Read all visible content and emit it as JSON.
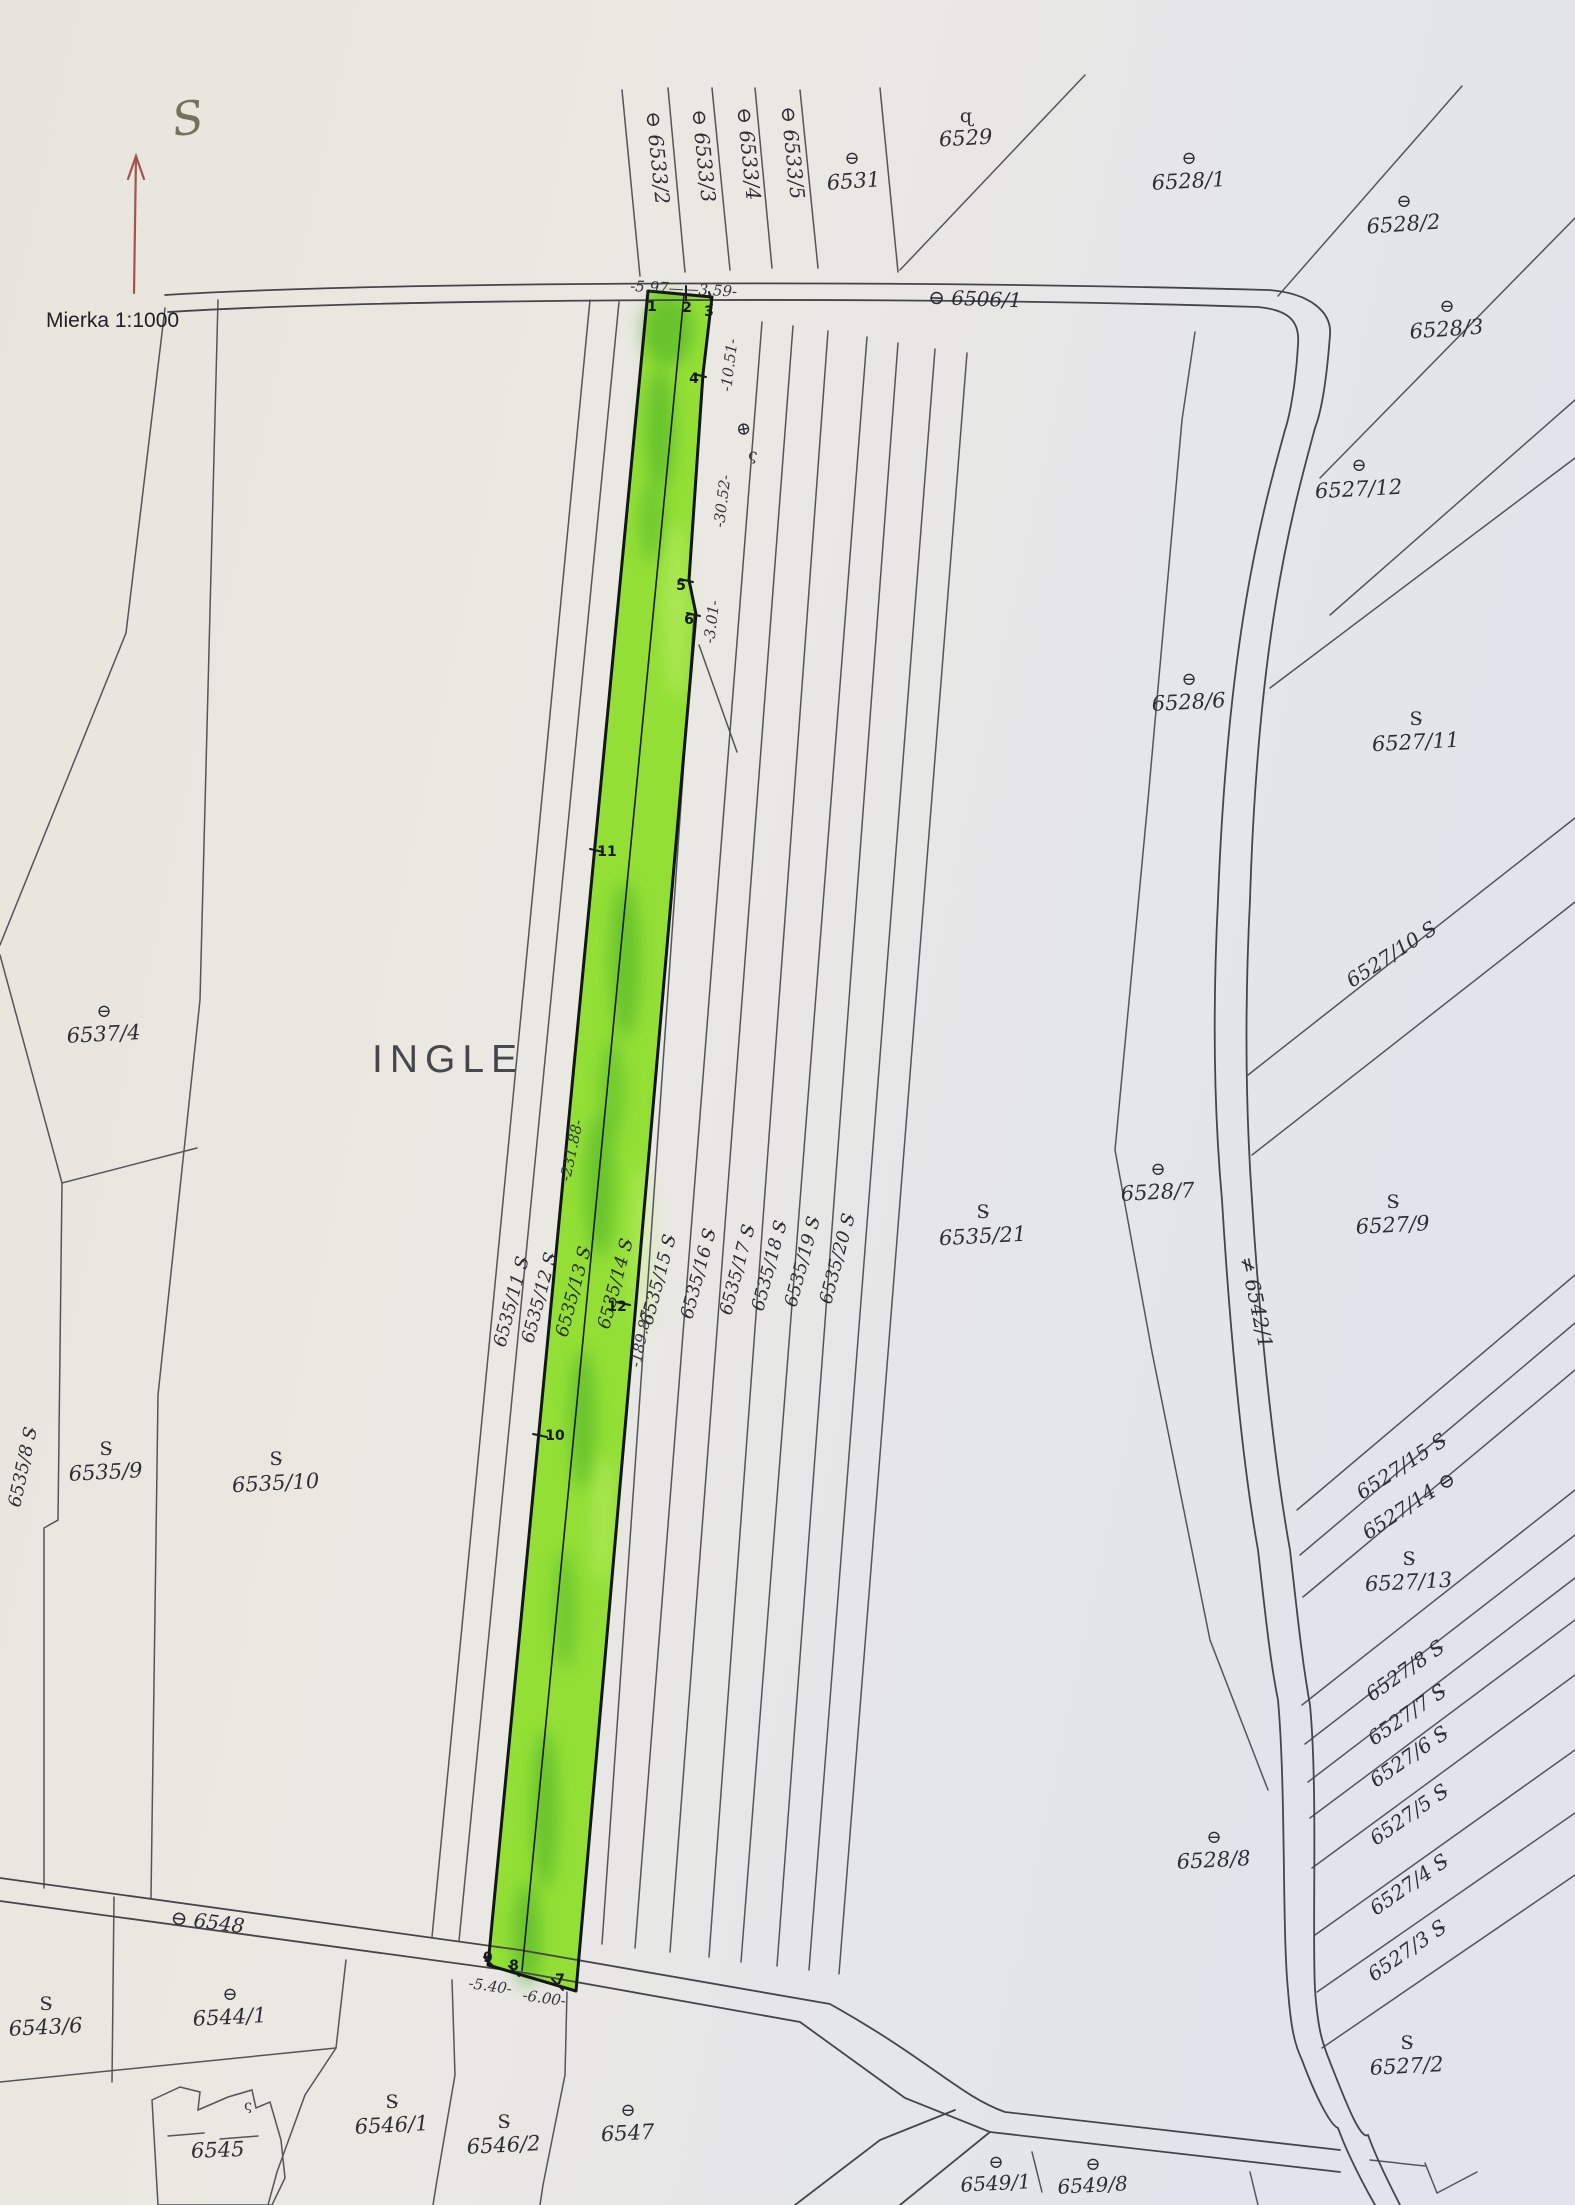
{
  "document": {
    "type": "cadastral-map-scan",
    "scale_label": "Mierka 1:1000",
    "north_label": "S",
    "area_name": "INGLE",
    "highlighted_parcels": [
      "6535/13",
      "6535/14"
    ]
  },
  "map": {
    "paper_color": "#e8e6e1",
    "line_color": "#53555a",
    "highlight_color": "#93df36",
    "north_arrow_color": "#a3544b",
    "labels": [
      {
        "n": "north-label",
        "t": "S",
        "x": 190,
        "y": 134,
        "r": -8,
        "s": 46,
        "a": "m",
        "c": "north"
      },
      {
        "n": "scale-label",
        "t": "Mierka 1:1000",
        "x": 46,
        "y": 327,
        "r": 0,
        "s": 21,
        "a": "s",
        "c": "scale"
      },
      {
        "n": "area-name",
        "t": "INGLE",
        "x": 372,
        "y": 1072,
        "r": 0,
        "s": 39,
        "a": "s",
        "c": "area"
      },
      {
        "n": "parcel-label-6533-2",
        "t": "⊖ 6533/2",
        "x": 646,
        "y": 112,
        "r": 84,
        "s": 20,
        "a": "s",
        "c": "num"
      },
      {
        "n": "parcel-label-6533-3",
        "t": "⊖ 6533/3",
        "x": 692,
        "y": 110,
        "r": 84,
        "s": 20,
        "a": "s",
        "c": "num"
      },
      {
        "n": "parcel-label-6533-4",
        "t": "⊖ 6533/4",
        "x": 737,
        "y": 108,
        "r": 84,
        "s": 20,
        "a": "s",
        "c": "num"
      },
      {
        "n": "parcel-label-6533-5",
        "t": "⊖ 6533/5",
        "x": 781,
        "y": 107,
        "r": 84,
        "s": 20,
        "a": "s",
        "c": "num"
      },
      {
        "n": "symbol-6531",
        "t": "⊖",
        "x": 852,
        "y": 164,
        "r": 0,
        "s": 18,
        "a": "m",
        "c": "sym"
      },
      {
        "n": "parcel-label-6531",
        "t": "6531",
        "x": 854,
        "y": 188,
        "r": -4,
        "s": 21,
        "a": "m",
        "c": "num"
      },
      {
        "n": "symbol-6529",
        "t": "ɋ",
        "x": 966,
        "y": 122,
        "r": 0,
        "s": 19,
        "a": "m",
        "c": "sym"
      },
      {
        "n": "parcel-label-6529",
        "t": "6529",
        "x": 966,
        "y": 145,
        "r": -3,
        "s": 21,
        "a": "m",
        "c": "num"
      },
      {
        "n": "parcel-label-6506-1",
        "t": "⊖ 6506/1",
        "x": 928,
        "y": 304,
        "r": 2,
        "s": 20,
        "a": "s",
        "c": "num"
      },
      {
        "n": "symbol-6528-1",
        "t": "⊖",
        "x": 1189,
        "y": 164,
        "r": 0,
        "s": 18,
        "a": "m",
        "c": "sym"
      },
      {
        "n": "parcel-label-6528-1",
        "t": "6528/1",
        "x": 1189,
        "y": 188,
        "r": -3,
        "s": 21,
        "a": "m",
        "c": "num"
      },
      {
        "n": "symbol-6528-2",
        "t": "⊖",
        "x": 1404,
        "y": 207,
        "r": 0,
        "s": 18,
        "a": "m",
        "c": "sym"
      },
      {
        "n": "parcel-label-6528-2",
        "t": "6528/2",
        "x": 1404,
        "y": 231,
        "r": -4,
        "s": 21,
        "a": "m",
        "c": "num"
      },
      {
        "n": "symbol-6528-3",
        "t": "⊖",
        "x": 1447,
        "y": 312,
        "r": 0,
        "s": 18,
        "a": "m",
        "c": "sym"
      },
      {
        "n": "parcel-label-6528-3",
        "t": "6528/3",
        "x": 1447,
        "y": 336,
        "r": -4,
        "s": 21,
        "a": "m",
        "c": "num"
      },
      {
        "n": "symbol-6527-12",
        "t": "⊖",
        "x": 1359,
        "y": 471,
        "r": 0,
        "s": 18,
        "a": "m",
        "c": "sym"
      },
      {
        "n": "parcel-label-6527-12",
        "t": "6527/12",
        "x": 1359,
        "y": 496,
        "r": -3,
        "s": 21,
        "a": "m",
        "c": "num"
      },
      {
        "n": "symbol-6528-6",
        "t": "⊖",
        "x": 1189,
        "y": 685,
        "r": 0,
        "s": 18,
        "a": "m",
        "c": "sym"
      },
      {
        "n": "parcel-label-6528-6",
        "t": "6528/6",
        "x": 1189,
        "y": 709,
        "r": -3,
        "s": 21,
        "a": "m",
        "c": "num"
      },
      {
        "n": "symbol-6527-11",
        "t": "S̵",
        "x": 1416,
        "y": 725,
        "r": 0,
        "s": 19,
        "a": "m",
        "c": "sym"
      },
      {
        "n": "parcel-label-6527-11",
        "t": "6527/11",
        "x": 1416,
        "y": 749,
        "r": -3,
        "s": 21,
        "a": "m",
        "c": "num"
      },
      {
        "n": "parcel-label-6527-10",
        "t": "6527/10 S̵",
        "x": 1352,
        "y": 988,
        "r": -33,
        "s": 20,
        "a": "s",
        "c": "num"
      },
      {
        "n": "symbol-6527-9",
        "t": "S̵",
        "x": 1393,
        "y": 1208,
        "r": 0,
        "s": 19,
        "a": "m",
        "c": "sym"
      },
      {
        "n": "parcel-label-6527-9",
        "t": "6527/9",
        "x": 1393,
        "y": 1232,
        "r": -3,
        "s": 21,
        "a": "m",
        "c": "num"
      },
      {
        "n": "symbol-6528-7",
        "t": "⊖",
        "x": 1158,
        "y": 1175,
        "r": 0,
        "s": 18,
        "a": "m",
        "c": "sym"
      },
      {
        "n": "parcel-label-6528-7",
        "t": "6528/7",
        "x": 1158,
        "y": 1199,
        "r": -3,
        "s": 21,
        "a": "m",
        "c": "num"
      },
      {
        "n": "parcel-label-6542-1",
        "t": "≠ 6542/1",
        "x": 1240,
        "y": 1258,
        "r": 78,
        "s": 20,
        "a": "s",
        "c": "num"
      },
      {
        "n": "symbol-6535-21",
        "t": "S̵",
        "x": 983,
        "y": 1218,
        "r": 0,
        "s": 19,
        "a": "m",
        "c": "sym"
      },
      {
        "n": "parcel-label-6535-21",
        "t": "6535/21",
        "x": 983,
        "y": 1243,
        "r": -3,
        "s": 21,
        "a": "m",
        "c": "num"
      },
      {
        "n": "parcel-label-6535-11",
        "t": "6535/11 S̵",
        "x": 505,
        "y": 1348,
        "r": -75,
        "s": 18,
        "a": "s",
        "c": "num"
      },
      {
        "n": "parcel-label-6535-12",
        "t": "6535/12 S̵",
        "x": 533,
        "y": 1344,
        "r": -75,
        "s": 18,
        "a": "s",
        "c": "num"
      },
      {
        "n": "parcel-label-6535-13",
        "t": "6535/13 S̵",
        "x": 567,
        "y": 1338,
        "r": -75,
        "s": 18,
        "a": "s",
        "c": "num"
      },
      {
        "n": "parcel-label-6535-14",
        "t": "6535/14 S̵",
        "x": 609,
        "y": 1330,
        "r": -75,
        "s": 18,
        "a": "s",
        "c": "num"
      },
      {
        "n": "parcel-label-6535-15",
        "t": "6535/15 S̵",
        "x": 652,
        "y": 1326,
        "r": -75,
        "s": 18,
        "a": "s",
        "c": "num"
      },
      {
        "n": "parcel-label-6535-16",
        "t": "6535/16 S̵",
        "x": 692,
        "y": 1320,
        "r": -75,
        "s": 18,
        "a": "s",
        "c": "num"
      },
      {
        "n": "parcel-label-6535-17",
        "t": "6535/17 S̵",
        "x": 731,
        "y": 1316,
        "r": -75,
        "s": 18,
        "a": "s",
        "c": "num"
      },
      {
        "n": "parcel-label-6535-18",
        "t": "6535/18 S̵",
        "x": 763,
        "y": 1312,
        "r": -75,
        "s": 18,
        "a": "s",
        "c": "num"
      },
      {
        "n": "parcel-label-6535-19",
        "t": "6535/19 S̵",
        "x": 796,
        "y": 1308,
        "r": -75,
        "s": 18,
        "a": "s",
        "c": "num"
      },
      {
        "n": "parcel-label-6535-20",
        "t": "6535/20 S̵",
        "x": 831,
        "y": 1305,
        "r": -75,
        "s": 18,
        "a": "s",
        "c": "num"
      },
      {
        "n": "symbol-6537-4",
        "t": "⊖",
        "x": 104,
        "y": 1017,
        "r": 0,
        "s": 18,
        "a": "m",
        "c": "sym"
      },
      {
        "n": "parcel-label-6537-4",
        "t": "6537/4",
        "x": 104,
        "y": 1041,
        "r": -3,
        "s": 21,
        "a": "m",
        "c": "num"
      },
      {
        "n": "parcel-label-6535-8",
        "t": "6535/8 S̵",
        "x": 20,
        "y": 1508,
        "r": -78,
        "s": 18,
        "a": "s",
        "c": "num"
      },
      {
        "n": "symbol-6535-9",
        "t": "S̵",
        "x": 106,
        "y": 1455,
        "r": 0,
        "s": 19,
        "a": "m",
        "c": "sym"
      },
      {
        "n": "parcel-label-6535-9",
        "t": "6535/9",
        "x": 106,
        "y": 1479,
        "r": -3,
        "s": 21,
        "a": "m",
        "c": "num"
      },
      {
        "n": "symbol-6535-10",
        "t": "S̵",
        "x": 276,
        "y": 1465,
        "r": 0,
        "s": 19,
        "a": "m",
        "c": "sym"
      },
      {
        "n": "parcel-label-6535-10",
        "t": "6535/10",
        "x": 276,
        "y": 1490,
        "r": -3,
        "s": 21,
        "a": "m",
        "c": "num"
      },
      {
        "n": "parcel-label-6527-15",
        "t": "6527/15 S̵",
        "x": 1362,
        "y": 1500,
        "r": -33,
        "s": 20,
        "a": "s",
        "c": "num"
      },
      {
        "n": "parcel-label-6527-14",
        "t": "6527/14 ⊖",
        "x": 1368,
        "y": 1540,
        "r": -33,
        "s": 20,
        "a": "s",
        "c": "num"
      },
      {
        "n": "symbol-6527-13",
        "t": "S̵",
        "x": 1409,
        "y": 1565,
        "r": 0,
        "s": 19,
        "a": "m",
        "c": "sym"
      },
      {
        "n": "parcel-label-6527-13",
        "t": "6527/13",
        "x": 1409,
        "y": 1589,
        "r": -3,
        "s": 21,
        "a": "m",
        "c": "num"
      },
      {
        "n": "parcel-label-6527-8",
        "t": "6527/8 S̵",
        "x": 1372,
        "y": 1702,
        "r": -35,
        "s": 20,
        "a": "s",
        "c": "num"
      },
      {
        "n": "parcel-label-6527-7",
        "t": "6527/7 S̵",
        "x": 1374,
        "y": 1746,
        "r": -35,
        "s": 20,
        "a": "s",
        "c": "num"
      },
      {
        "n": "parcel-label-6527-6",
        "t": "6527/6 S̵",
        "x": 1376,
        "y": 1788,
        "r": -35,
        "s": 20,
        "a": "s",
        "c": "num"
      },
      {
        "n": "parcel-label-6527-5",
        "t": "6527/5 S̵",
        "x": 1376,
        "y": 1846,
        "r": -35,
        "s": 20,
        "a": "s",
        "c": "num"
      },
      {
        "n": "parcel-label-6527-4",
        "t": "6527/4 S̵",
        "x": 1376,
        "y": 1916,
        "r": -35,
        "s": 20,
        "a": "s",
        "c": "num"
      },
      {
        "n": "parcel-label-6527-3",
        "t": "6527/3 S̵",
        "x": 1374,
        "y": 1982,
        "r": -35,
        "s": 20,
        "a": "s",
        "c": "num"
      },
      {
        "n": "symbol-6528-8",
        "t": "⊖",
        "x": 1214,
        "y": 1843,
        "r": 0,
        "s": 18,
        "a": "m",
        "c": "sym"
      },
      {
        "n": "parcel-label-6528-8",
        "t": "6528/8",
        "x": 1214,
        "y": 1867,
        "r": -3,
        "s": 21,
        "a": "m",
        "c": "num"
      },
      {
        "n": "symbol-6527-2",
        "t": "S̵",
        "x": 1407,
        "y": 2049,
        "r": 0,
        "s": 19,
        "a": "m",
        "c": "sym"
      },
      {
        "n": "parcel-label-6527-2",
        "t": "6527/2",
        "x": 1407,
        "y": 2073,
        "r": -3,
        "s": 21,
        "a": "m",
        "c": "num"
      },
      {
        "n": "parcel-label-6548",
        "t": "⊖ 6548",
        "x": 170,
        "y": 1924,
        "r": 7,
        "s": 20,
        "a": "s",
        "c": "num"
      },
      {
        "n": "symbol-6543-6",
        "t": "S̵",
        "x": 46,
        "y": 2010,
        "r": 0,
        "s": 19,
        "a": "m",
        "c": "sym"
      },
      {
        "n": "parcel-label-6543-6",
        "t": "6543/6",
        "x": 46,
        "y": 2034,
        "r": -3,
        "s": 21,
        "a": "m",
        "c": "num"
      },
      {
        "n": "symbol-6544-1",
        "t": "⊖",
        "x": 230,
        "y": 2000,
        "r": 0,
        "s": 18,
        "a": "m",
        "c": "sym"
      },
      {
        "n": "parcel-label-6544-1",
        "t": "6544/1",
        "x": 230,
        "y": 2024,
        "r": -3,
        "s": 21,
        "a": "m",
        "c": "num"
      },
      {
        "n": "parcel-label-6545",
        "t": "6545",
        "x": 218,
        "y": 2157,
        "r": -2,
        "s": 21,
        "a": "m",
        "c": "num"
      },
      {
        "n": "symbol-6546-1",
        "t": "S̵",
        "x": 392,
        "y": 2108,
        "r": 0,
        "s": 19,
        "a": "m",
        "c": "sym"
      },
      {
        "n": "parcel-label-6546-1",
        "t": "6546/1",
        "x": 392,
        "y": 2132,
        "r": -3,
        "s": 21,
        "a": "m",
        "c": "num"
      },
      {
        "n": "symbol-6546-2",
        "t": "S̵",
        "x": 504,
        "y": 2128,
        "r": 0,
        "s": 19,
        "a": "m",
        "c": "sym"
      },
      {
        "n": "parcel-label-6546-2",
        "t": "6546/2",
        "x": 504,
        "y": 2152,
        "r": -3,
        "s": 21,
        "a": "m",
        "c": "num"
      },
      {
        "n": "symbol-6547",
        "t": "⊖",
        "x": 628,
        "y": 2116,
        "r": 0,
        "s": 18,
        "a": "m",
        "c": "sym"
      },
      {
        "n": "parcel-label-6547",
        "t": "6547",
        "x": 628,
        "y": 2140,
        "r": -3,
        "s": 21,
        "a": "m",
        "c": "num"
      },
      {
        "n": "symbol-6549-1",
        "t": "⊖",
        "x": 996,
        "y": 2168,
        "r": 0,
        "s": 18,
        "a": "m",
        "c": "sym"
      },
      {
        "n": "parcel-label-6549-1",
        "t": "6549/1",
        "x": 996,
        "y": 2190,
        "r": -3,
        "s": 20,
        "a": "m",
        "c": "num"
      },
      {
        "n": "symbol-6549-8",
        "t": "⊖",
        "x": 1093,
        "y": 2170,
        "r": 0,
        "s": 18,
        "a": "m",
        "c": "sym"
      },
      {
        "n": "parcel-label-6549-8",
        "t": "6549/8",
        "x": 1093,
        "y": 2192,
        "r": -3,
        "s": 20,
        "a": "m",
        "c": "num"
      },
      {
        "n": "measurement-top",
        "t": "-5.97——3.59-",
        "x": 630,
        "y": 291,
        "r": 3,
        "s": 15,
        "a": "s",
        "c": "meas"
      },
      {
        "n": "measurement-10-51",
        "t": "-10.51-",
        "x": 731,
        "y": 392,
        "r": -83,
        "s": 15,
        "a": "s",
        "c": "meas"
      },
      {
        "n": "measurement-30-52",
        "t": "-30.52-",
        "x": 724,
        "y": 528,
        "r": -83,
        "s": 15,
        "a": "s",
        "c": "meas"
      },
      {
        "n": "measurement-3-01",
        "t": "-3.01-",
        "x": 714,
        "y": 644,
        "r": -83,
        "s": 15,
        "a": "s",
        "c": "meas"
      },
      {
        "n": "measurement-231-88",
        "t": "-231.88-",
        "x": 570,
        "y": 1182,
        "r": -78,
        "s": 15,
        "a": "s",
        "c": "meas"
      },
      {
        "n": "measurement-189-87",
        "t": "-189.87-",
        "x": 640,
        "y": 1368,
        "r": -78,
        "s": 15,
        "a": "s",
        "c": "meas"
      },
      {
        "n": "measurement-5-40",
        "t": "-5.40-",
        "x": 468,
        "y": 1988,
        "r": 8,
        "s": 15,
        "a": "s",
        "c": "meas"
      },
      {
        "n": "measurement-6-00",
        "t": "-6.00-",
        "x": 522,
        "y": 2000,
        "r": 8,
        "s": 15,
        "a": "s",
        "c": "meas"
      },
      {
        "n": "point-1",
        "t": "1",
        "x": 652,
        "y": 311,
        "r": 0,
        "s": 14,
        "a": "m",
        "c": "pt"
      },
      {
        "n": "point-2",
        "t": "2",
        "x": 687,
        "y": 312,
        "r": 0,
        "s": 14,
        "a": "m",
        "c": "pt"
      },
      {
        "n": "point-3",
        "t": "3",
        "x": 709,
        "y": 316,
        "r": 0,
        "s": 14,
        "a": "m",
        "c": "pt"
      },
      {
        "n": "point-4",
        "t": "4",
        "x": 694,
        "y": 383,
        "r": 0,
        "s": 14,
        "a": "m",
        "c": "pt"
      },
      {
        "n": "point-5",
        "t": "5",
        "x": 681,
        "y": 590,
        "r": 0,
        "s": 14,
        "a": "m",
        "c": "pt"
      },
      {
        "n": "point-6",
        "t": "6",
        "x": 689,
        "y": 624,
        "r": 0,
        "s": 14,
        "a": "m",
        "c": "pt"
      },
      {
        "n": "point-11",
        "t": "11",
        "x": 607,
        "y": 856,
        "r": 0,
        "s": 14,
        "a": "m",
        "c": "pt"
      },
      {
        "n": "point-12",
        "t": "12",
        "x": 617,
        "y": 1311,
        "r": 0,
        "s": 14,
        "a": "m",
        "c": "pt"
      },
      {
        "n": "point-10",
        "t": "10",
        "x": 555,
        "y": 1440,
        "r": 0,
        "s": 14,
        "a": "m",
        "c": "pt"
      },
      {
        "n": "point-9",
        "t": "9",
        "x": 488,
        "y": 1962,
        "r": 0,
        "s": 14,
        "a": "m",
        "c": "pt"
      },
      {
        "n": "point-8",
        "t": "8",
        "x": 514,
        "y": 1970,
        "r": 0,
        "s": 14,
        "a": "m",
        "c": "pt"
      },
      {
        "n": "point-7",
        "t": "7",
        "x": 560,
        "y": 1984,
        "r": 0,
        "s": 14,
        "a": "m",
        "c": "pt"
      },
      {
        "n": "symbol-circle-plus",
        "t": "⊕",
        "x": 738,
        "y": 430,
        "r": 80,
        "s": 18,
        "a": "m",
        "c": "sym"
      },
      {
        "n": "symbol-sigma-1",
        "t": "ς",
        "x": 752,
        "y": 460,
        "r": 10,
        "s": 16,
        "a": "m",
        "c": "sym"
      },
      {
        "n": "symbol-sigma-2",
        "t": "ς",
        "x": 248,
        "y": 2110,
        "r": 0,
        "s": 14,
        "a": "m",
        "c": "sym"
      }
    ]
  }
}
